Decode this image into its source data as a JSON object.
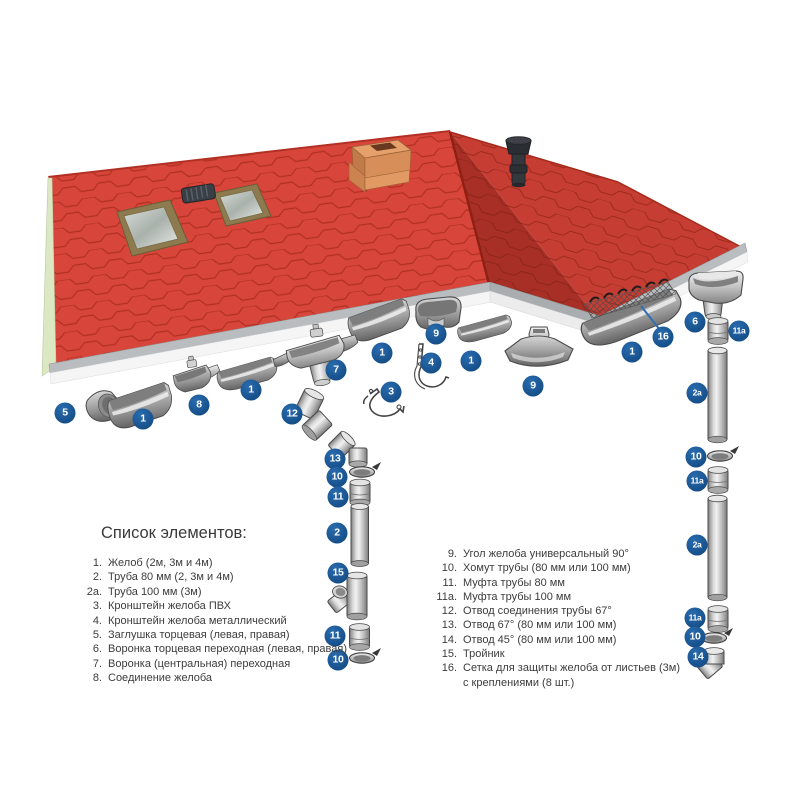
{
  "legend": {
    "title": "Список элементов:",
    "left_items": [
      {
        "num": "1.",
        "text": "Желоб (2м, 3м и 4м)"
      },
      {
        "num": "2.",
        "text": "Труба 80 мм (2, 3м и 4м)"
      },
      {
        "num": "2а.",
        "text": "Труба 100 мм (3м)"
      },
      {
        "num": "3.",
        "text": "Кронштейн желоба ПВХ"
      },
      {
        "num": "4.",
        "text": "Кронштейн желоба металлический"
      },
      {
        "num": "5.",
        "text": "Заглушка торцевая (левая, правая)"
      },
      {
        "num": "6.",
        "text": "Воронка торцевая переходная (левая, правая)"
      },
      {
        "num": "7.",
        "text": "Воронка (центральная) переходная"
      },
      {
        "num": "8.",
        "text": "Соединение желоба"
      }
    ],
    "right_items": [
      {
        "num": "9.",
        "text": "Угол желоба универсальный 90°"
      },
      {
        "num": "10.",
        "text": "Хомут трубы (80 мм или 100 мм)"
      },
      {
        "num": "11.",
        "text": "Муфта трубы 80 мм"
      },
      {
        "num": "11а.",
        "text": "Муфта трубы 100 мм"
      },
      {
        "num": "12.",
        "text": "Отвод соединения трубы 67°"
      },
      {
        "num": "13.",
        "text": "Отвод 67° (80 мм или 100 мм)"
      },
      {
        "num": "14.",
        "text": "Отвод 45° (80 мм или 100 мм)"
      },
      {
        "num": "15.",
        "text": "Тройник"
      },
      {
        "num": "16.",
        "text": "Сетка для защиты желоба от листьев (3м)",
        "text2": "с креплениями (8 шт.)"
      }
    ]
  },
  "badges": [
    {
      "label": "5",
      "x": 65,
      "y": 413
    },
    {
      "label": "1",
      "x": 143,
      "y": 419
    },
    {
      "label": "8",
      "x": 199,
      "y": 405
    },
    {
      "label": "1",
      "x": 251,
      "y": 390
    },
    {
      "label": "7",
      "x": 336,
      "y": 370
    },
    {
      "label": "12",
      "x": 292,
      "y": 414
    },
    {
      "label": "3",
      "x": 391,
      "y": 392
    },
    {
      "label": "1",
      "x": 382,
      "y": 353
    },
    {
      "label": "9",
      "x": 436,
      "y": 334
    },
    {
      "label": "4",
      "x": 431,
      "y": 363
    },
    {
      "label": "1",
      "x": 471,
      "y": 361
    },
    {
      "label": "9",
      "x": 533,
      "y": 386
    },
    {
      "label": "1",
      "x": 632,
      "y": 352
    },
    {
      "label": "16",
      "x": 663,
      "y": 337
    },
    {
      "label": "6",
      "x": 695,
      "y": 322
    },
    {
      "label": "11а",
      "x": 739,
      "y": 331,
      "small": true
    },
    {
      "label": "2а",
      "x": 697,
      "y": 393,
      "small": true
    },
    {
      "label": "10",
      "x": 696,
      "y": 457
    },
    {
      "label": "11а",
      "x": 697,
      "y": 481,
      "small": true
    },
    {
      "label": "2а",
      "x": 697,
      "y": 545,
      "small": true
    },
    {
      "label": "11а",
      "x": 695,
      "y": 618,
      "small": true
    },
    {
      "label": "10",
      "x": 695,
      "y": 637
    },
    {
      "label": "14",
      "x": 698,
      "y": 657
    },
    {
      "label": "13",
      "x": 335,
      "y": 459
    },
    {
      "label": "10",
      "x": 337,
      "y": 477
    },
    {
      "label": "11",
      "x": 338,
      "y": 497
    },
    {
      "label": "2",
      "x": 337,
      "y": 533
    },
    {
      "label": "15",
      "x": 338,
      "y": 573
    },
    {
      "label": "11",
      "x": 335,
      "y": 636
    },
    {
      "label": "10",
      "x": 338,
      "y": 660
    }
  ],
  "colors": {
    "badge_blue": "#17518c",
    "leader_blue": "#2f6fb2",
    "roof_red": "#d8453a",
    "roof_red_wing": "#cf4136",
    "roof_red_dark": "#c0372b",
    "shingle_line": "#a62a1c",
    "gable_green": "#dce8c4",
    "fascia_white": "#f5f5f5",
    "fascia_cap": "#b9bdc0",
    "metal_light": "#f1f1f1",
    "metal_dark": "#636363",
    "text": "#3c3c3c",
    "background": "#ffffff"
  }
}
